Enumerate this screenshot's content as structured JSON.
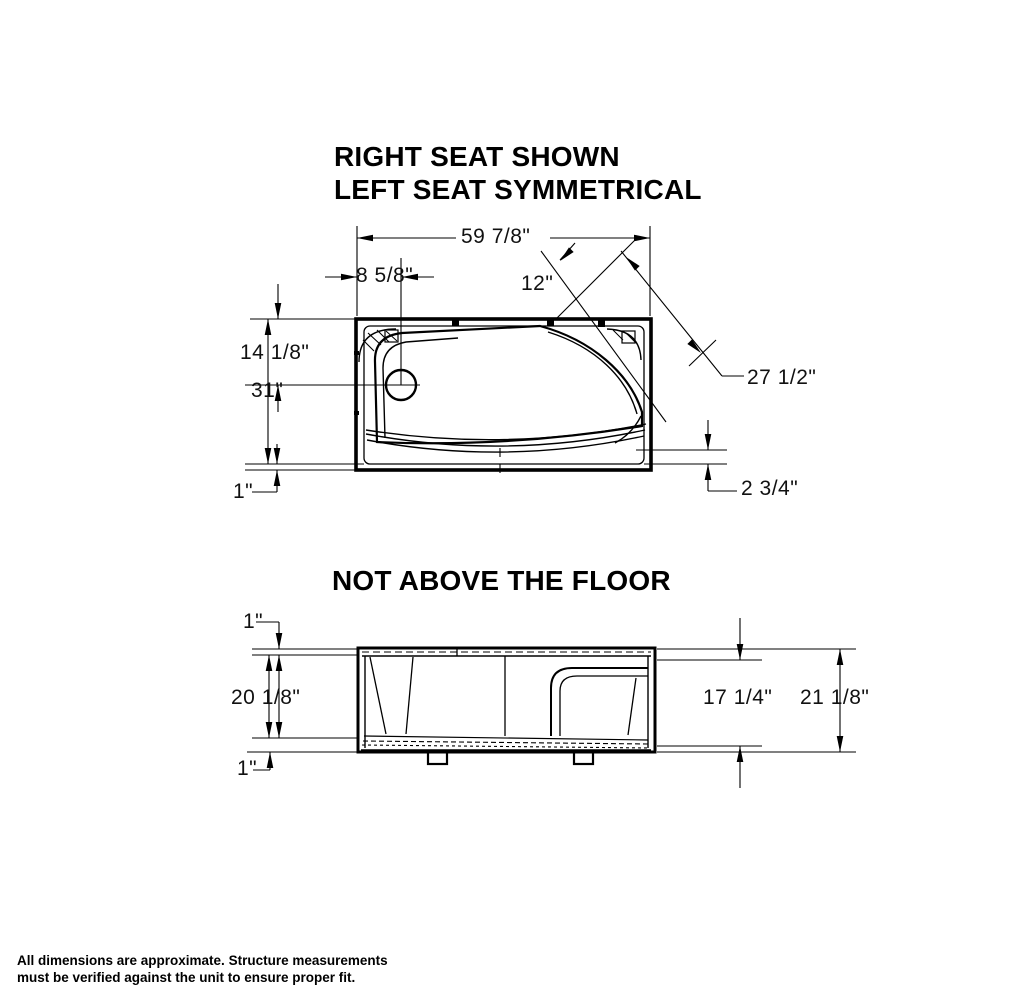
{
  "title": {
    "line1": "RIGHT SEAT SHOWN",
    "line2": "LEFT SEAT SYMMETRICAL"
  },
  "section2_title": "NOT ABOVE THE FLOOR",
  "top_view": {
    "dims": {
      "overall_width": "59 7/8\"",
      "drain_offset": "8 5/8\"",
      "seat_width": "12\"",
      "seat_diagonal": "27 1/2\"",
      "drain_setback": "14 1/8\"",
      "overall_depth": "31\"",
      "rim_front": "1\"",
      "seat_corner": "2 3/4\""
    }
  },
  "side_view": {
    "dims": {
      "rim_top": "1\"",
      "apron_height": "20 1/8\"",
      "rim_bottom": "1\"",
      "inner_height": "17 1/4\"",
      "overall_height": "21 1/8\""
    }
  },
  "footer": {
    "line1": "All dimensions are approximate. Structure measurements",
    "line2": "must be verified against the unit to ensure proper fit."
  },
  "colors": {
    "line": "#000000",
    "background": "#ffffff"
  }
}
